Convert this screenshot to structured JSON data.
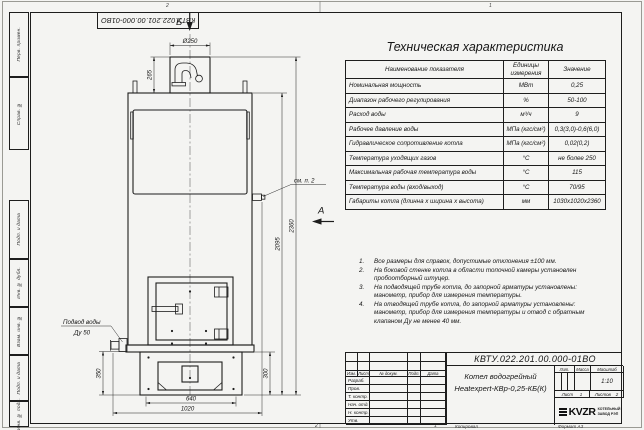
{
  "colors": {
    "paper": "#f4f4f2",
    "ink": "#1d1d1d"
  },
  "frame": {
    "doc_number_top": "КВТУ.022.201.00.000-01ВО",
    "side_labels": [
      "Перв. примен.",
      "Справ. №",
      "Подп. и дата",
      "Инв. № дубл.",
      "Взам. инв. №",
      "Подп. и дата",
      "Инв. № подл."
    ],
    "zone_top_left": "2",
    "zone_top_right": "1",
    "zone_bottom_left": "2",
    "zone_bottom_right": "1",
    "copied_label": "Копировал",
    "format_label": "Формат А3"
  },
  "spec_table": {
    "title": "Техническая характеристика",
    "col_name": "Наименование показателя",
    "col_units": "Единицы измерения",
    "col_value": "Значение",
    "rows": [
      {
        "name": "Номинальная мощность",
        "units": "МВт",
        "value": "0,25"
      },
      {
        "name": "Диапазон рабочего регулирования",
        "units": "%",
        "value": "50-100"
      },
      {
        "name": "Расход воды",
        "units": "м³/ч",
        "value": "9"
      },
      {
        "name": "Рабочее давление воды",
        "units": "МПа (кгс/см²)",
        "value": "0,3(3,0)-0,6(6,0)"
      },
      {
        "name": "Гидравлическое сопротивление котла",
        "units": "МПа (кгс/см²)",
        "value": "0,02(0,2)"
      },
      {
        "name": "Температура уходящих газов",
        "units": "°С",
        "value": "не более 250"
      },
      {
        "name": "Максимальная рабочая температура воды",
        "units": "°С",
        "value": "115"
      },
      {
        "name": "Температура воды (вход/выход)",
        "units": "°С",
        "value": "70/95"
      },
      {
        "name": "Габариты котла (длинна х ширина х высота)",
        "units": "мм",
        "value": "1030х1020х2360"
      }
    ]
  },
  "notes": {
    "items": [
      {
        "num": "1.",
        "text": "Все размеры для справок, допустимые отклонения ±100 мм."
      },
      {
        "num": "2.",
        "text": "На боковой стенке котла в области топочной камеры установлен пробоотборный штуцер."
      },
      {
        "num": "3.",
        "text": "На подводящей трубе котла, до запорной арматуры установлены: манометр, прибор для измерения температуры."
      },
      {
        "num": "4.",
        "text": "На отводящей трубе котла, до запорной арматуры установлены: манометр, прибор для измерения температуры и отвод с обратным клапаном Ду не менее 40 мм."
      }
    ]
  },
  "drawing": {
    "view_top_label": "Б",
    "view_side_label": "А",
    "callout_see_note": "см. п. 2",
    "water_inlet_label": "Подвод воды",
    "water_inlet_size": "Ду 50",
    "dim_diameter": "Ø250",
    "dim_chimney_height": "265",
    "dim_total_height": "2360",
    "dim_body_height": "2095",
    "dim_base_height_left": "350",
    "dim_base_height_right": "300",
    "dim_base_width": "640",
    "dim_total_width": "1020"
  },
  "title_block": {
    "doc_number": "КВТУ.022.201.00.000-01ВО",
    "product_name_line1": "Котел водогрейный",
    "product_name_line2": "Heatexpert-КВр-0,25-КБ(К)",
    "header_cols": [
      "Изм.",
      "Лист",
      "№ докум.",
      "Подп.",
      "Дата"
    ],
    "row_labels": [
      "Разраб.",
      "Пров.",
      "Т. контр.",
      "Нач. отд.",
      "Н. контр.",
      "Утв."
    ],
    "lit_label": "Лит.",
    "mass_label": "Масса",
    "scale_label": "Масштаб",
    "scale_value": "1:10",
    "sheet_label": "Лист",
    "sheet_value": "1",
    "sheets_label": "Листов",
    "sheets_value": "2",
    "logo_text": "KVZR",
    "logo_caption_line1": "КОТЕЛЬНЫЙ",
    "logo_caption_line2": "ЗАВОД РЭП"
  }
}
